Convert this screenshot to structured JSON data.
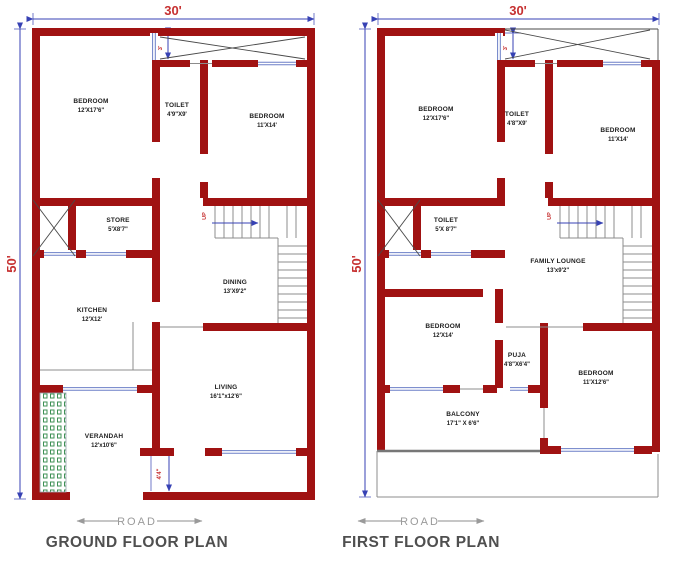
{
  "colors": {
    "wall": "#a01212",
    "dimension_line": "#3742b4",
    "dimension_text": "#c63030",
    "room_text": "#1c1c1c",
    "stair_gray": "#8c8c8c",
    "window_blue": "#6b7fc7",
    "verandah_green": "#3f9156",
    "title_text": "#4f4f4f",
    "road_text": "#9a9a9a",
    "background": "#ffffff"
  },
  "ground": {
    "title": "GROUND FLOOR PLAN",
    "road_label": "ROAD",
    "width_dim": "30'",
    "height_dim": "50'",
    "strip_dim": "3'",
    "porch_dim": "4'4\"",
    "up_label": "UP",
    "rooms": [
      {
        "name": "BEDROOM",
        "dims": "12'X17'6\""
      },
      {
        "name": "TOILET",
        "dims": "4'9\"X9'"
      },
      {
        "name": "BEDROOM",
        "dims": "11'X14'"
      },
      {
        "name": "STORE",
        "dims": "5'X8'7\""
      },
      {
        "name": "DINING",
        "dims": "13'X9'2\""
      },
      {
        "name": "KITCHEN",
        "dims": "12'X12'"
      },
      {
        "name": "LIVING",
        "dims": "16'1\"x12'6\""
      },
      {
        "name": "VERANDAH",
        "dims": "12'x10'6\""
      }
    ]
  },
  "first": {
    "title": "FIRST FLOOR PLAN",
    "road_label": "ROAD",
    "width_dim": "30'",
    "height_dim": "50'",
    "strip_dim": "3'",
    "up_label": "UP",
    "rooms": [
      {
        "name": "BEDROOM",
        "dims": "12'X17'6\""
      },
      {
        "name": "TOILET",
        "dims": "4'8\"X9'"
      },
      {
        "name": "BEDROOM",
        "dims": "11'X14'"
      },
      {
        "name": "TOILET",
        "dims": "5'X 8'7\""
      },
      {
        "name": "FAMILY LOUNGE",
        "dims": "13'x9'2\""
      },
      {
        "name": "BEDROOM",
        "dims": "12'X14'"
      },
      {
        "name": "PUJA",
        "dims": "4'8\"X6'4\""
      },
      {
        "name": "BEDROOM",
        "dims": "11'X12'6\""
      },
      {
        "name": "BALCONY",
        "dims": "17'1\" X 6'6\""
      }
    ]
  }
}
